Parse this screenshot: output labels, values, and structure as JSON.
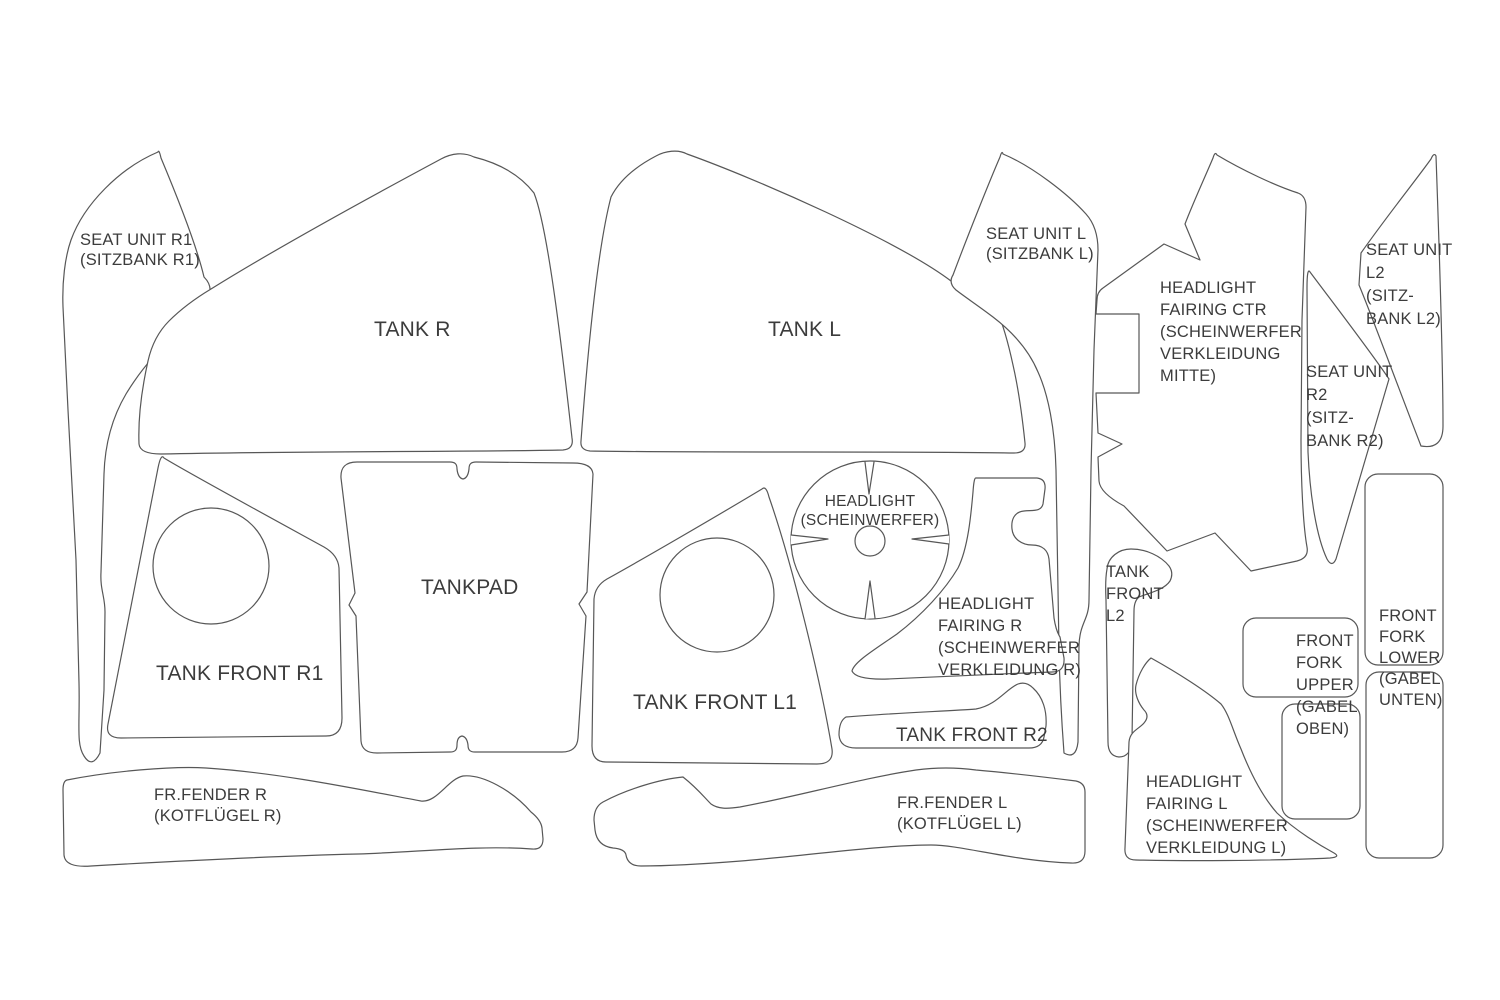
{
  "diagram": {
    "description": "Motorcycle paint protection film pre-cut kit cutting pattern sheet",
    "colors": {
      "background": "#ffffff",
      "outline": "#575757",
      "text": "#3c3c3c"
    },
    "labels": {
      "seat_unit_r1": "SEAT UNIT R1\n(SITZBANK R1)",
      "tank_r": "TANK R",
      "tank_l": "TANK L",
      "seat_unit_l": "SEAT UNIT L\n(SITZBANK L)",
      "headlight_fairing_ctr": "HEADLIGHT\nFAIRING CTR\n(SCHEINWERFER\nVERKLEIDUNG\nMITTE)",
      "seat_unit_l2": "SEAT UNIT\nL2\n(SITZ-\nBANK L2)",
      "seat_unit_r2": "SEAT UNIT\nR2\n(SITZ-\nBANK R2)",
      "tank_front_r1": "TANK FRONT R1",
      "tankpad": "TANKPAD",
      "tank_front_l1": "TANK FRONT L1",
      "headlight": "HEADLIGHT\n(SCHEINWERFER)",
      "headlight_fairing_r": "HEADLIGHT\nFAIRING R\n(SCHEINWERFER\nVERKLEIDUNG R)",
      "tank_front_r2": "TANK FRONT R2",
      "tank_front_l2": "TANK\nFRONT\nL2",
      "front_fork_upper": "FRONT\nFORK\nUPPER\n(GABEL\nOBEN)",
      "front_fork_lower": "FRONT\nFORK\nLOWER\n(GABEL\nUNTEN)",
      "headlight_fairing_l": "HEADLIGHT\nFAIRING L\n(SCHEINWERFER\nVERKLEIDUNG L)",
      "fr_fender_r": "FR.FENDER R\n(KOTFLÜGEL R)",
      "fr_fender_l": "FR.FENDER L\n(KOTFLÜGEL L)"
    }
  }
}
